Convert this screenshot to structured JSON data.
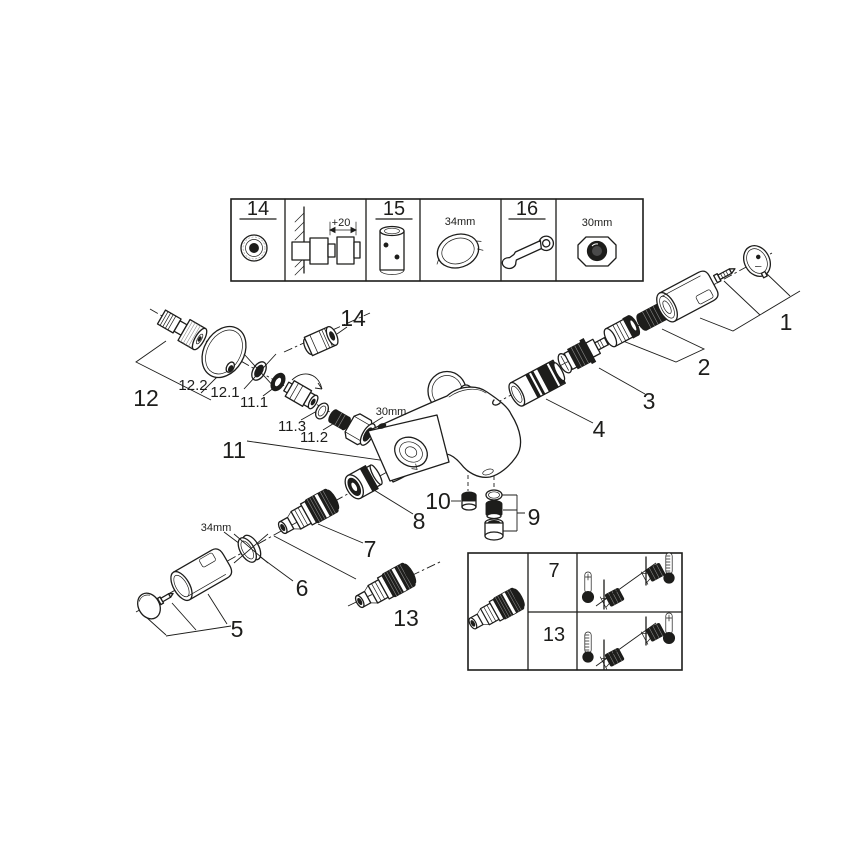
{
  "colors": {
    "ink": "#1d1d1b",
    "paper": "#ffffff"
  },
  "top_reference_strip": {
    "items": [
      {
        "label": "14",
        "icon": "cap-nut-icon"
      },
      {
        "label": "+20",
        "icon": "wall-spacer-dimension-icon"
      },
      {
        "label": "15",
        "icon": "extension-tool-icon"
      },
      {
        "label": "34mm",
        "icon": "ring-nut-icon"
      },
      {
        "label": "16",
        "icon": "open-end-wrench-icon"
      },
      {
        "label": "30mm",
        "icon": "cap-nut-front-icon"
      }
    ]
  },
  "callouts": {
    "p1": "1",
    "p2": "2",
    "p3": "3",
    "p4": "4",
    "p5": "5",
    "p6": "6",
    "p7": "7",
    "p8": "8",
    "p9": "9",
    "p10": "10",
    "p11": "11",
    "p11_1": "11.1",
    "p11_2": "11.2",
    "p11_3": "11.3",
    "p12": "12",
    "p12_1": "12.1",
    "p12_2": "12.2",
    "p13": "13",
    "p14": "14"
  },
  "dimension_labels": {
    "union_nut": "30mm",
    "spout_collar": "34mm"
  },
  "check_valve_table": {
    "rows": [
      {
        "label": "7"
      },
      {
        "label": "13"
      }
    ],
    "icons": [
      "check-valve-icon",
      "thermometer-warm-icon",
      "thermometer-scale-icon"
    ]
  }
}
